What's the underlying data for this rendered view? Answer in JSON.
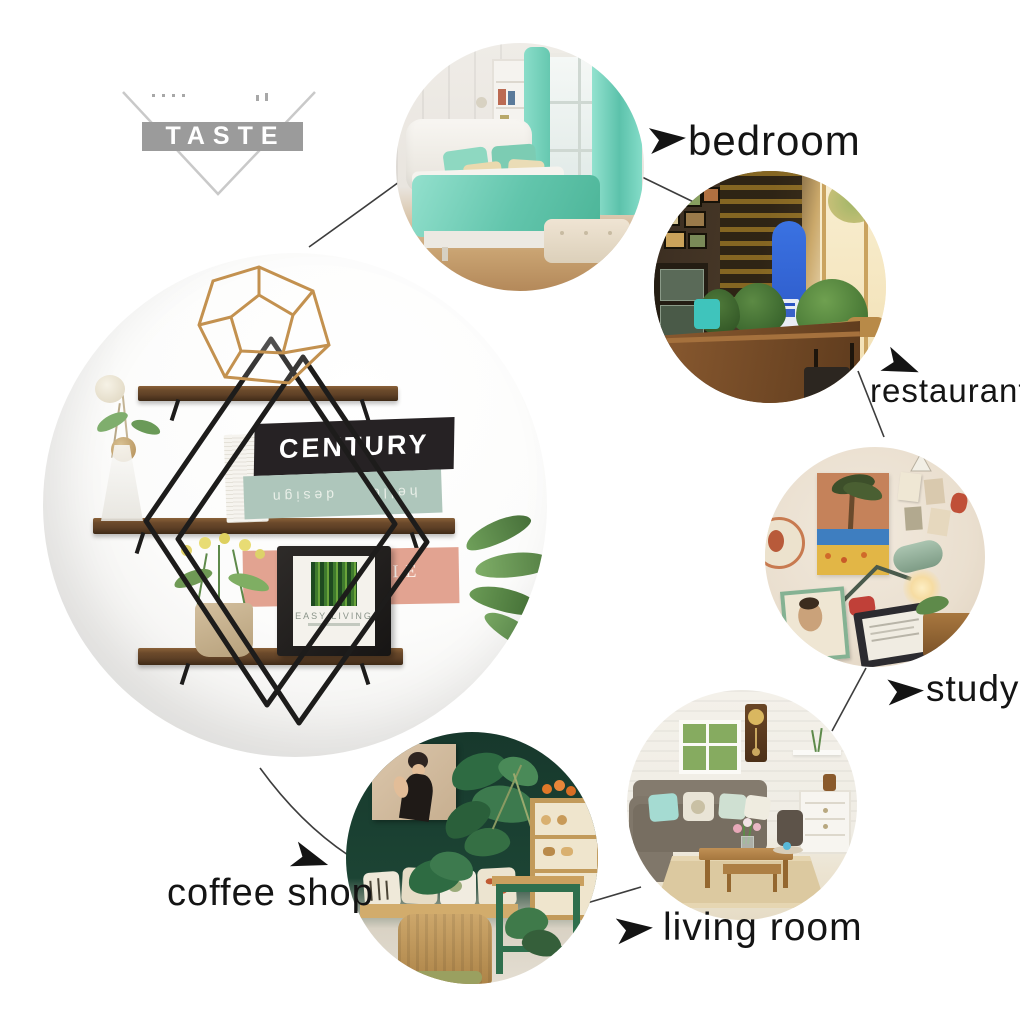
{
  "watermark": {
    "text": "TASTE"
  },
  "callouts": {
    "bedroom": {
      "label": "bedroom"
    },
    "restaurant": {
      "label": "restaurant"
    },
    "study": {
      "label": "study"
    },
    "living_room": {
      "label": "living room"
    },
    "coffee_shop": {
      "label": "coffee shop"
    }
  },
  "product": {
    "books": {
      "top_title": "CENTURY",
      "middle_spine_upside_down": "hello design",
      "bottom_title": "NATHALIE",
      "bottom_subtitle": "schwer"
    },
    "frame_caption": "EASY LIVING"
  },
  "colors": {
    "watermark_gray": "#9b9b9b",
    "connector_line": "#3d3d3d",
    "label_text": "#141414",
    "shelf_wood": "#5e4026",
    "frame_metal": "#1d1c1b",
    "brass": "#c3914f",
    "book_black": "#262224",
    "book_sage": "#aec6bb",
    "book_pink": "#e2a391",
    "bedroom_mint": "#7fd3bc",
    "surfboard_blue": "#2f63d8",
    "coffee_wall_green": "#17382c"
  }
}
